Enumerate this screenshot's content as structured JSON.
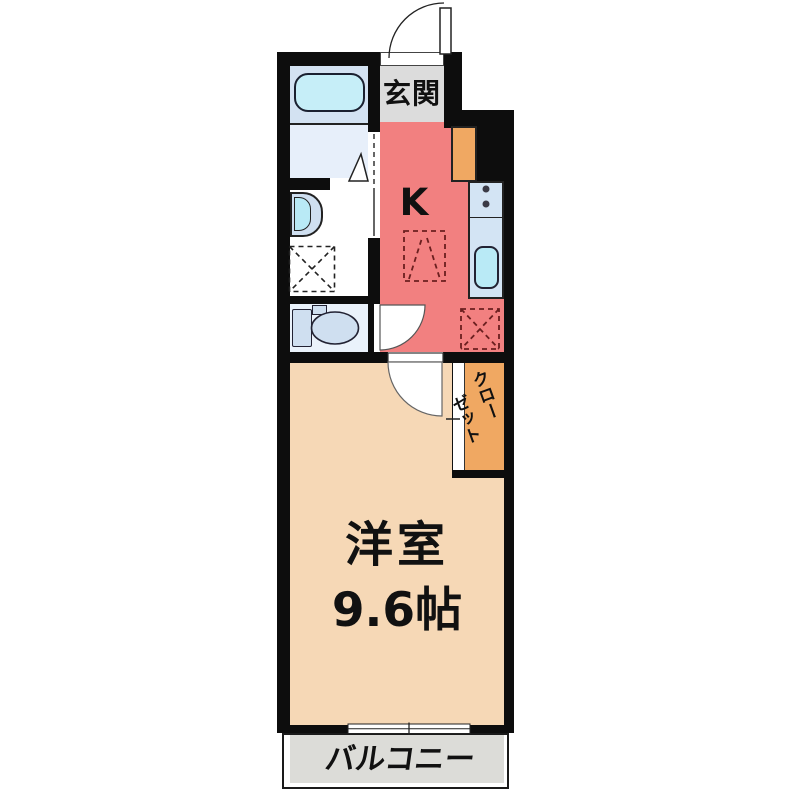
{
  "floorplan": {
    "type": "apartment-1K-floor-plan",
    "rooms": {
      "genkan": {
        "label": "玄関"
      },
      "kitchen": {
        "label": "K"
      },
      "living": {
        "label_line1": "洋室",
        "label_line2": "9.6帖",
        "label": "洋室 9.6帖"
      },
      "closet": {
        "label": "クローゼット",
        "label_col1": "クロー",
        "label_col2": "ゼット"
      },
      "balcony": {
        "label": "バルコニー"
      }
    },
    "fixtures": [
      "bathtub",
      "bath-door",
      "washbasin",
      "washing-machine-space",
      "toilet",
      "entrance-door",
      "shoe-cabinet",
      "kitchen-counter",
      "stove-burners",
      "kitchen-sink",
      "overhead-cupboard-symbol",
      "refrigerator-space",
      "toilet-door",
      "room-door",
      "closet-sliding-door",
      "sliding-window"
    ],
    "colors": {
      "wall": "#0d0d0d",
      "kitchen": "#f28080",
      "room": "#f6d8b6",
      "closet": "#f0a862",
      "cabinet": "#f0a862",
      "genkan": "#dcdcdc",
      "balcony": "#dcdcd8",
      "bath_upper": "#d3e2f2",
      "bath_lower": "#e7effa",
      "toilet_room": "#eaf2fb",
      "fixture": "#cfdff0",
      "counter": "#d3e4f4",
      "water": "#b9eaf6",
      "tub": "#c6eef8",
      "dash_red": "#6b1f1f",
      "text": "#111111"
    }
  }
}
